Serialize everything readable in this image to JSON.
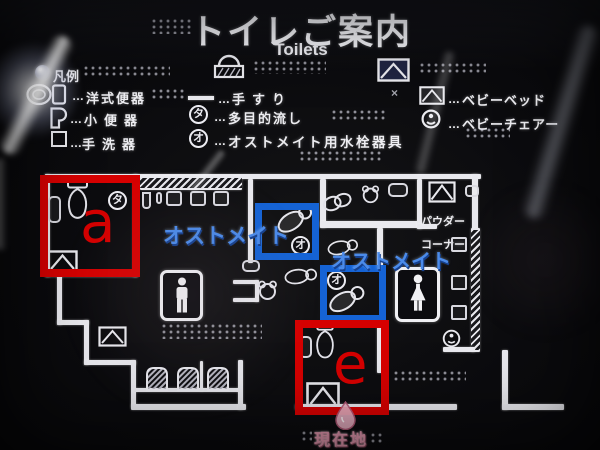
{
  "title": {
    "ja": "トイレご案内",
    "en": "Toilets"
  },
  "badges": {
    "multi": "タ",
    "ostomate": "オ"
  },
  "legend": {
    "heading": "凡例",
    "dots": "…",
    "cross": "×",
    "left": [
      {
        "label": "洋式便器",
        "icon": "western-toilet-icon"
      },
      {
        "label": "小便器",
        "icon": "urinal-icon"
      },
      {
        "label": "手洗器",
        "icon": "hand-basin-icon"
      }
    ],
    "middle": [
      {
        "label": "手すり",
        "icon": "handrail-icon"
      },
      {
        "label": "多目的流し",
        "icon": "multipurpose-sink-badge"
      },
      {
        "label": "オストメイト用水栓器具",
        "icon": "ostomate-fixture-badge"
      }
    ],
    "right": [
      {
        "label": "ベビーベッド",
        "icon": "baby-bed-icon"
      },
      {
        "label": "ベビーチェアー",
        "icon": "baby-chair-icon"
      }
    ]
  },
  "map": {
    "marker_a": "a",
    "marker_e": "e",
    "ostomate_label": "オストメイト",
    "powder_corner": [
      "パウダー",
      "コーナー"
    ],
    "current_location": "現在地"
  },
  "colors": {
    "red_annotation": "#d60000",
    "blue_annotation": "#1563d5",
    "blue_label_text": "#4b8bea",
    "pink_marker": "#de93aa",
    "wall_white": "#e9e9ee",
    "background": "#0b0b0e"
  }
}
